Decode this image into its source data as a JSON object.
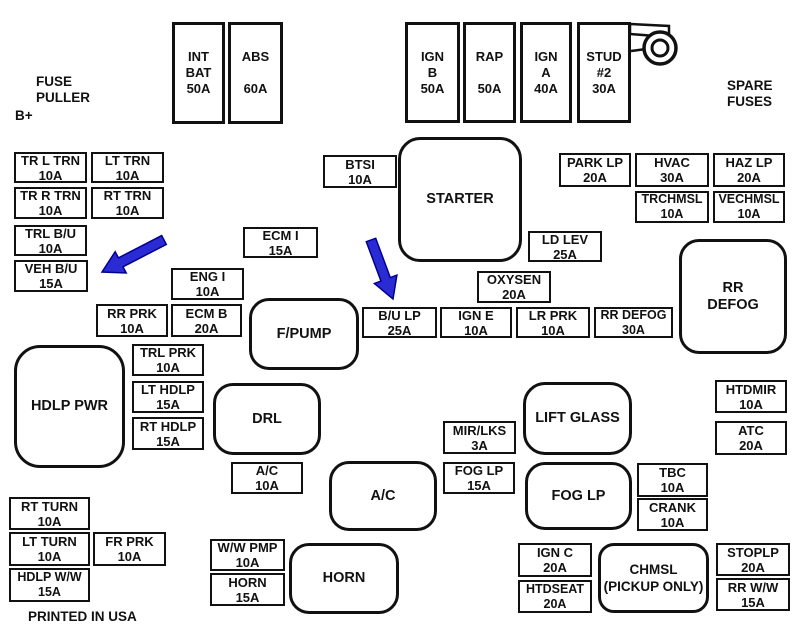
{
  "page": {
    "width": 796,
    "height": 627,
    "background": "#ffffff"
  },
  "colors": {
    "line": "#111111",
    "text": "#111111",
    "arrow_fill": "#2b2bd4",
    "arrow_stroke": "#000090"
  },
  "labels": [
    {
      "name": "fuse-puller-label",
      "lines": [
        "FUSE",
        "PULLER"
      ],
      "x": 36,
      "y": 74
    },
    {
      "name": "b-plus-label",
      "lines": [
        "B+"
      ],
      "x": 15,
      "y": 108
    },
    {
      "name": "spare-fuses-label",
      "lines": [
        "SPARE",
        "FUSES"
      ],
      "x": 727,
      "y": 78
    },
    {
      "name": "printed-in-usa-label",
      "lines": [
        "PRINTED IN USA"
      ],
      "x": 28,
      "y": 609
    }
  ],
  "fuses": [
    {
      "name": "fuse-int-bat",
      "label": [
        "INT",
        "BAT",
        "50A"
      ],
      "x": 172,
      "y": 22,
      "w": 53,
      "h": 102,
      "tall": true
    },
    {
      "name": "fuse-abs",
      "label": [
        "ABS",
        " ",
        "60A"
      ],
      "x": 228,
      "y": 22,
      "w": 55,
      "h": 102,
      "tall": true
    },
    {
      "name": "fuse-ign-b",
      "label": [
        "IGN",
        "B",
        "50A"
      ],
      "x": 405,
      "y": 22,
      "w": 55,
      "h": 101,
      "tall": true
    },
    {
      "name": "fuse-rap",
      "label": [
        "RAP",
        " ",
        "50A"
      ],
      "x": 463,
      "y": 22,
      "w": 53,
      "h": 101,
      "tall": true
    },
    {
      "name": "fuse-ign-a",
      "label": [
        "IGN",
        "A",
        "40A"
      ],
      "x": 520,
      "y": 22,
      "w": 52,
      "h": 101,
      "tall": true
    },
    {
      "name": "fuse-stud-2",
      "label": [
        "STUD",
        "#2",
        "30A"
      ],
      "x": 577,
      "y": 22,
      "w": 54,
      "h": 101,
      "tall": true
    },
    {
      "name": "fuse-tr-l-trn",
      "label": [
        "TR L TRN",
        "10A"
      ],
      "x": 14,
      "y": 152,
      "w": 73,
      "h": 31
    },
    {
      "name": "fuse-lt-trn",
      "label": [
        "LT TRN",
        "10A"
      ],
      "x": 91,
      "y": 152,
      "w": 73,
      "h": 31
    },
    {
      "name": "fuse-tr-r-trn",
      "label": [
        "TR R TRN",
        "10A"
      ],
      "x": 14,
      "y": 187,
      "w": 73,
      "h": 32
    },
    {
      "name": "fuse-rt-trn",
      "label": [
        "RT TRN",
        "10A"
      ],
      "x": 91,
      "y": 187,
      "w": 73,
      "h": 32
    },
    {
      "name": "fuse-trl-bu",
      "label": [
        "TRL B/U",
        "10A"
      ],
      "x": 14,
      "y": 225,
      "w": 73,
      "h": 31
    },
    {
      "name": "fuse-veh-bu",
      "label": [
        "VEH B/U",
        "15A"
      ],
      "x": 14,
      "y": 260,
      "w": 74,
      "h": 32
    },
    {
      "name": "fuse-btsi",
      "label": [
        "BTSI",
        "10A"
      ],
      "x": 323,
      "y": 155,
      "w": 74,
      "h": 33
    },
    {
      "name": "fuse-park-lp",
      "label": [
        "PARK LP",
        "20A"
      ],
      "x": 559,
      "y": 153,
      "w": 72,
      "h": 34
    },
    {
      "name": "fuse-hvac",
      "label": [
        "HVAC",
        "30A"
      ],
      "x": 635,
      "y": 153,
      "w": 74,
      "h": 34
    },
    {
      "name": "fuse-haz-lp",
      "label": [
        "HAZ LP",
        "20A"
      ],
      "x": 713,
      "y": 153,
      "w": 72,
      "h": 34
    },
    {
      "name": "fuse-trchmsl",
      "label": [
        "TRCHMSL",
        "10A"
      ],
      "x": 635,
      "y": 191,
      "w": 74,
      "h": 32,
      "fs": 12.5
    },
    {
      "name": "fuse-vechmsl",
      "label": [
        "VECHMSL",
        "10A"
      ],
      "x": 713,
      "y": 191,
      "w": 72,
      "h": 32,
      "fs": 12.5
    },
    {
      "name": "fuse-ecm-i",
      "label": [
        "ECM I",
        "15A"
      ],
      "x": 243,
      "y": 227,
      "w": 75,
      "h": 31
    },
    {
      "name": "fuse-ld-lev",
      "label": [
        "LD LEV",
        "25A"
      ],
      "x": 528,
      "y": 231,
      "w": 74,
      "h": 31
    },
    {
      "name": "fuse-eng-i",
      "label": [
        "ENG I",
        "10A"
      ],
      "x": 171,
      "y": 268,
      "w": 73,
      "h": 32
    },
    {
      "name": "fuse-oxysen",
      "label": [
        "OXYSEN",
        "20A"
      ],
      "x": 477,
      "y": 271,
      "w": 74,
      "h": 32
    },
    {
      "name": "fuse-rr-prk",
      "label": [
        "RR PRK",
        "10A"
      ],
      "x": 96,
      "y": 304,
      "w": 72,
      "h": 33
    },
    {
      "name": "fuse-ecm-b",
      "label": [
        "ECM B",
        "20A"
      ],
      "x": 171,
      "y": 304,
      "w": 71,
      "h": 33
    },
    {
      "name": "fuse-bu-lp",
      "label": [
        "B/U LP",
        "25A"
      ],
      "x": 362,
      "y": 307,
      "w": 75,
      "h": 31
    },
    {
      "name": "fuse-ign-e",
      "label": [
        "IGN E",
        "10A"
      ],
      "x": 440,
      "y": 307,
      "w": 72,
      "h": 31
    },
    {
      "name": "fuse-lr-prk",
      "label": [
        "LR PRK",
        "10A"
      ],
      "x": 516,
      "y": 307,
      "w": 74,
      "h": 31
    },
    {
      "name": "fuse-rr-defog",
      "label": [
        "RR DEFOG",
        "30A"
      ],
      "x": 594,
      "y": 307,
      "w": 79,
      "h": 31,
      "fs": 12.5
    },
    {
      "name": "fuse-trl-prk",
      "label": [
        "TRL PRK",
        "10A"
      ],
      "x": 132,
      "y": 344,
      "w": 72,
      "h": 32
    },
    {
      "name": "fuse-lt-hdlp",
      "label": [
        "LT HDLP",
        "15A"
      ],
      "x": 132,
      "y": 381,
      "w": 72,
      "h": 32
    },
    {
      "name": "fuse-rt-hdlp",
      "label": [
        "RT HDLP",
        "15A"
      ],
      "x": 132,
      "y": 417,
      "w": 72,
      "h": 33
    },
    {
      "name": "fuse-htdmir",
      "label": [
        "HTDMIR",
        "10A"
      ],
      "x": 715,
      "y": 380,
      "w": 72,
      "h": 33
    },
    {
      "name": "fuse-atc",
      "label": [
        "ATC",
        "20A"
      ],
      "x": 715,
      "y": 421,
      "w": 72,
      "h": 34
    },
    {
      "name": "fuse-mir-lks",
      "label": [
        "MIR/LKS",
        "3A"
      ],
      "x": 443,
      "y": 421,
      "w": 73,
      "h": 33
    },
    {
      "name": "fuse-ac",
      "label": [
        "A/C",
        "10A"
      ],
      "x": 231,
      "y": 462,
      "w": 72,
      "h": 32
    },
    {
      "name": "fuse-fog-lp",
      "label": [
        "FOG LP",
        "15A"
      ],
      "x": 443,
      "y": 462,
      "w": 72,
      "h": 32
    },
    {
      "name": "fuse-tbc",
      "label": [
        "TBC",
        "10A"
      ],
      "x": 637,
      "y": 463,
      "w": 71,
      "h": 34
    },
    {
      "name": "fuse-crank",
      "label": [
        "CRANK",
        "10A"
      ],
      "x": 637,
      "y": 498,
      "w": 71,
      "h": 33
    },
    {
      "name": "fuse-rt-turn",
      "label": [
        "RT TURN",
        "10A"
      ],
      "x": 9,
      "y": 497,
      "w": 81,
      "h": 33
    },
    {
      "name": "fuse-lt-turn",
      "label": [
        "LT TURN",
        "10A"
      ],
      "x": 9,
      "y": 532,
      "w": 81,
      "h": 34
    },
    {
      "name": "fuse-fr-prk",
      "label": [
        "FR PRK",
        "10A"
      ],
      "x": 93,
      "y": 532,
      "w": 73,
      "h": 34
    },
    {
      "name": "fuse-hdlp-ww",
      "label": [
        "HDLP W/W",
        "15A"
      ],
      "x": 9,
      "y": 568,
      "w": 81,
      "h": 34,
      "fs": 12.5
    },
    {
      "name": "fuse-ww-pmp",
      "label": [
        "W/W PMP",
        "10A"
      ],
      "x": 210,
      "y": 539,
      "w": 75,
      "h": 32
    },
    {
      "name": "fuse-horn",
      "label": [
        "HORN",
        "15A"
      ],
      "x": 210,
      "y": 573,
      "w": 75,
      "h": 33
    },
    {
      "name": "fuse-ign-c",
      "label": [
        "IGN C",
        "20A"
      ],
      "x": 518,
      "y": 543,
      "w": 74,
      "h": 34
    },
    {
      "name": "fuse-htdseat",
      "label": [
        "HTDSEAT",
        "20A"
      ],
      "x": 518,
      "y": 580,
      "w": 74,
      "h": 33,
      "fs": 12.5
    },
    {
      "name": "fuse-stoplp",
      "label": [
        "STOPLP",
        "20A"
      ],
      "x": 716,
      "y": 543,
      "w": 74,
      "h": 33
    },
    {
      "name": "fuse-rr-ww",
      "label": [
        "RR W/W",
        "15A"
      ],
      "x": 716,
      "y": 578,
      "w": 74,
      "h": 33
    }
  ],
  "relays": [
    {
      "name": "relay-starter",
      "label": [
        "STARTER"
      ],
      "x": 398,
      "y": 137,
      "w": 124,
      "h": 125,
      "r": 22
    },
    {
      "name": "relay-rr-defog",
      "label": [
        "RR",
        "DEFOG"
      ],
      "x": 679,
      "y": 239,
      "w": 108,
      "h": 115,
      "r": 20
    },
    {
      "name": "relay-f-pump",
      "label": [
        "F/PUMP"
      ],
      "x": 249,
      "y": 298,
      "w": 110,
      "h": 72,
      "r": 20
    },
    {
      "name": "relay-hdlp-pwr",
      "label": [
        "HDLP PWR"
      ],
      "x": 14,
      "y": 345,
      "w": 111,
      "h": 123,
      "r": 26
    },
    {
      "name": "relay-drl",
      "label": [
        "DRL"
      ],
      "x": 213,
      "y": 383,
      "w": 108,
      "h": 72,
      "r": 20
    },
    {
      "name": "relay-lift-glass",
      "label": [
        "LIFT GLASS"
      ],
      "x": 523,
      "y": 382,
      "w": 109,
      "h": 73,
      "r": 22
    },
    {
      "name": "relay-ac",
      "label": [
        "A/C"
      ],
      "x": 329,
      "y": 461,
      "w": 108,
      "h": 70,
      "r": 20
    },
    {
      "name": "relay-fog-lp",
      "label": [
        "FOG LP"
      ],
      "x": 525,
      "y": 462,
      "w": 107,
      "h": 68,
      "r": 20
    },
    {
      "name": "relay-horn",
      "label": [
        "HORN"
      ],
      "x": 289,
      "y": 543,
      "w": 110,
      "h": 71,
      "r": 20
    },
    {
      "name": "relay-chmsl",
      "label": [
        "CHMSL",
        "(PICKUP ONLY)"
      ],
      "x": 598,
      "y": 543,
      "w": 111,
      "h": 70,
      "r": 16,
      "fs": 13.5
    }
  ],
  "arrows": [
    {
      "name": "blue-arrow-veh-bu",
      "tail": [
        164,
        240
      ],
      "tip": [
        102,
        272
      ]
    },
    {
      "name": "blue-arrow-bu-lp",
      "tail": [
        371,
        240
      ],
      "tip": [
        393,
        299
      ]
    }
  ]
}
